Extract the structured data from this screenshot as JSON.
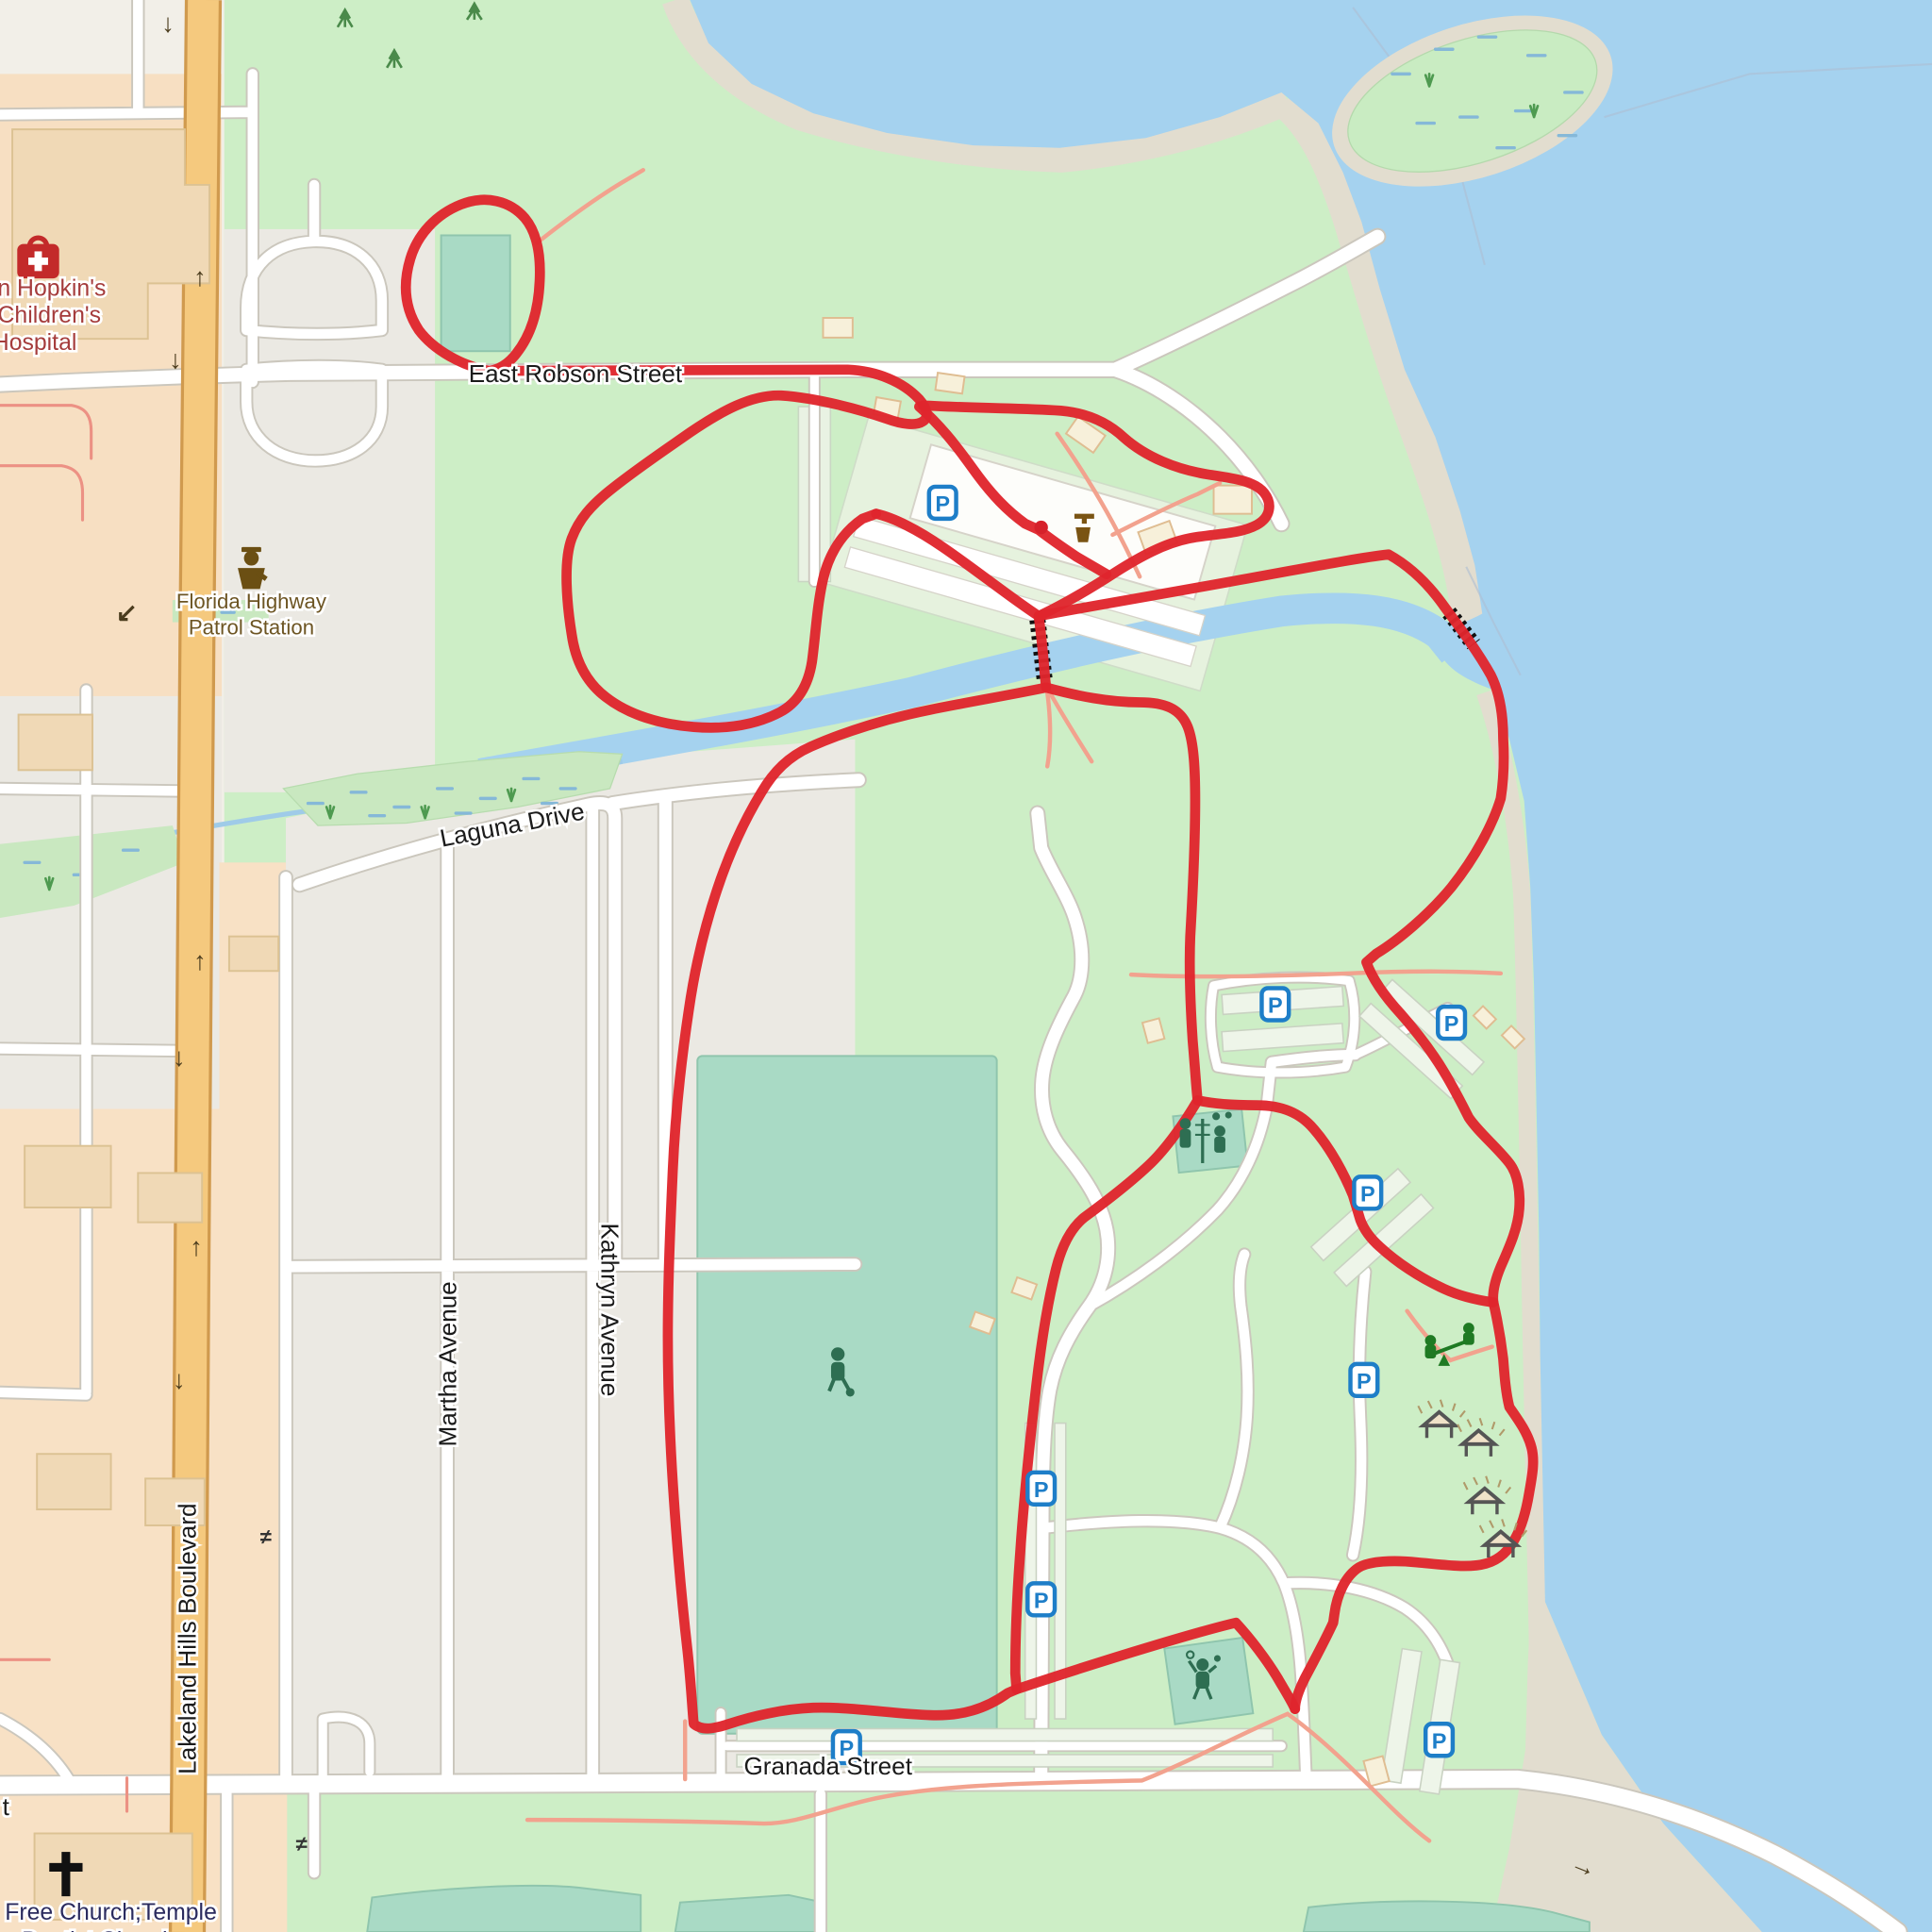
{
  "labels": {
    "east_robson": "East Robson Street",
    "laguna": "Laguna Drive",
    "martha": "Martha Avenue",
    "kathryn": "Kathryn Avenue",
    "lakeland_hills": "Lakeland Hills Boulevard",
    "granada": "Granada Street",
    "street_fragment": "t"
  },
  "pois": {
    "hospital": [
      "n Hopkin's",
      "Children's",
      "Hospital"
    ],
    "police": [
      "Florida Highway",
      "Patrol Station"
    ],
    "church": [
      "Free Church;Temple",
      "Baptist Church"
    ]
  },
  "markers": {
    "parking": "P"
  },
  "glyphs": {
    "up": "↑",
    "down": "↓",
    "left_down": "↙",
    "right": "→",
    "level_crossing": "≠"
  },
  "colors": {
    "route": "#e0252d",
    "water": "#a5d2ef",
    "park_green": "#cdeec6",
    "boulevard_orange": "#f5c97e",
    "parking_blue": "#1e7ec8",
    "path_salmon": "#f2a28e"
  }
}
